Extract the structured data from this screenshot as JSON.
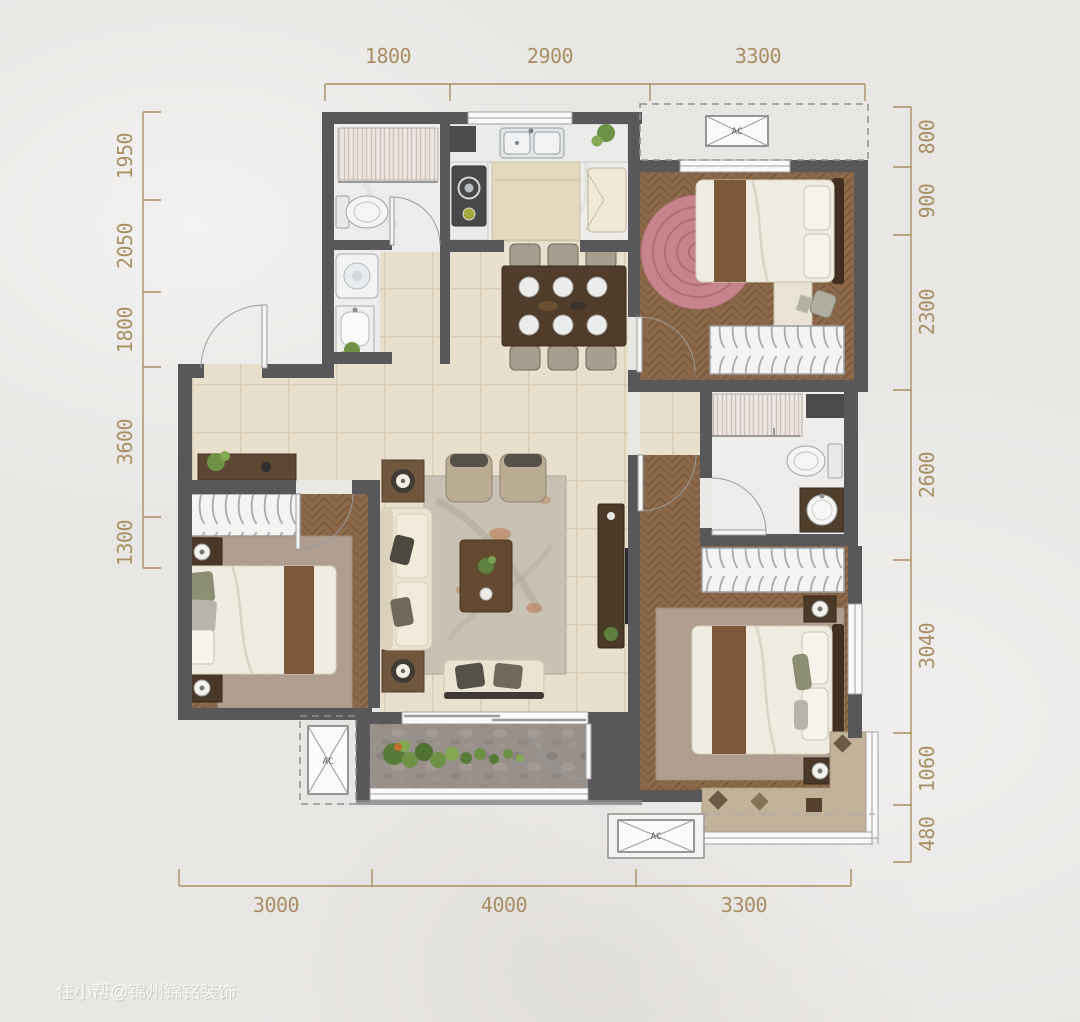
{
  "title": "apartment-floor-plan",
  "watermark": {
    "text": "住小帮@锦州锦铭装饰"
  },
  "dimensions": {
    "unit": "mm",
    "top": [
      "1800",
      "2900",
      "3300"
    ],
    "left": [
      "1950",
      "2050",
      "1800",
      "3600",
      "1300"
    ],
    "right": [
      "800",
      "900",
      "2300",
      "2600",
      "3040",
      "1060",
      "480"
    ],
    "bottom": [
      "3000",
      "4000",
      "3300"
    ]
  },
  "ac": {
    "label": "AC"
  },
  "colors": {
    "background": "#e9e7e4",
    "dimension_accent": "#a98f64",
    "wall": "#58585b",
    "tile_floor": "#e8e0cc",
    "wood_floor": "#8a6849",
    "marble_floor": "#eeedec",
    "balcony_stone": "#98908a",
    "round_rug_pink": "#c6858c",
    "area_rug": "#b3a294",
    "bed_runner": "#7c5a39"
  }
}
